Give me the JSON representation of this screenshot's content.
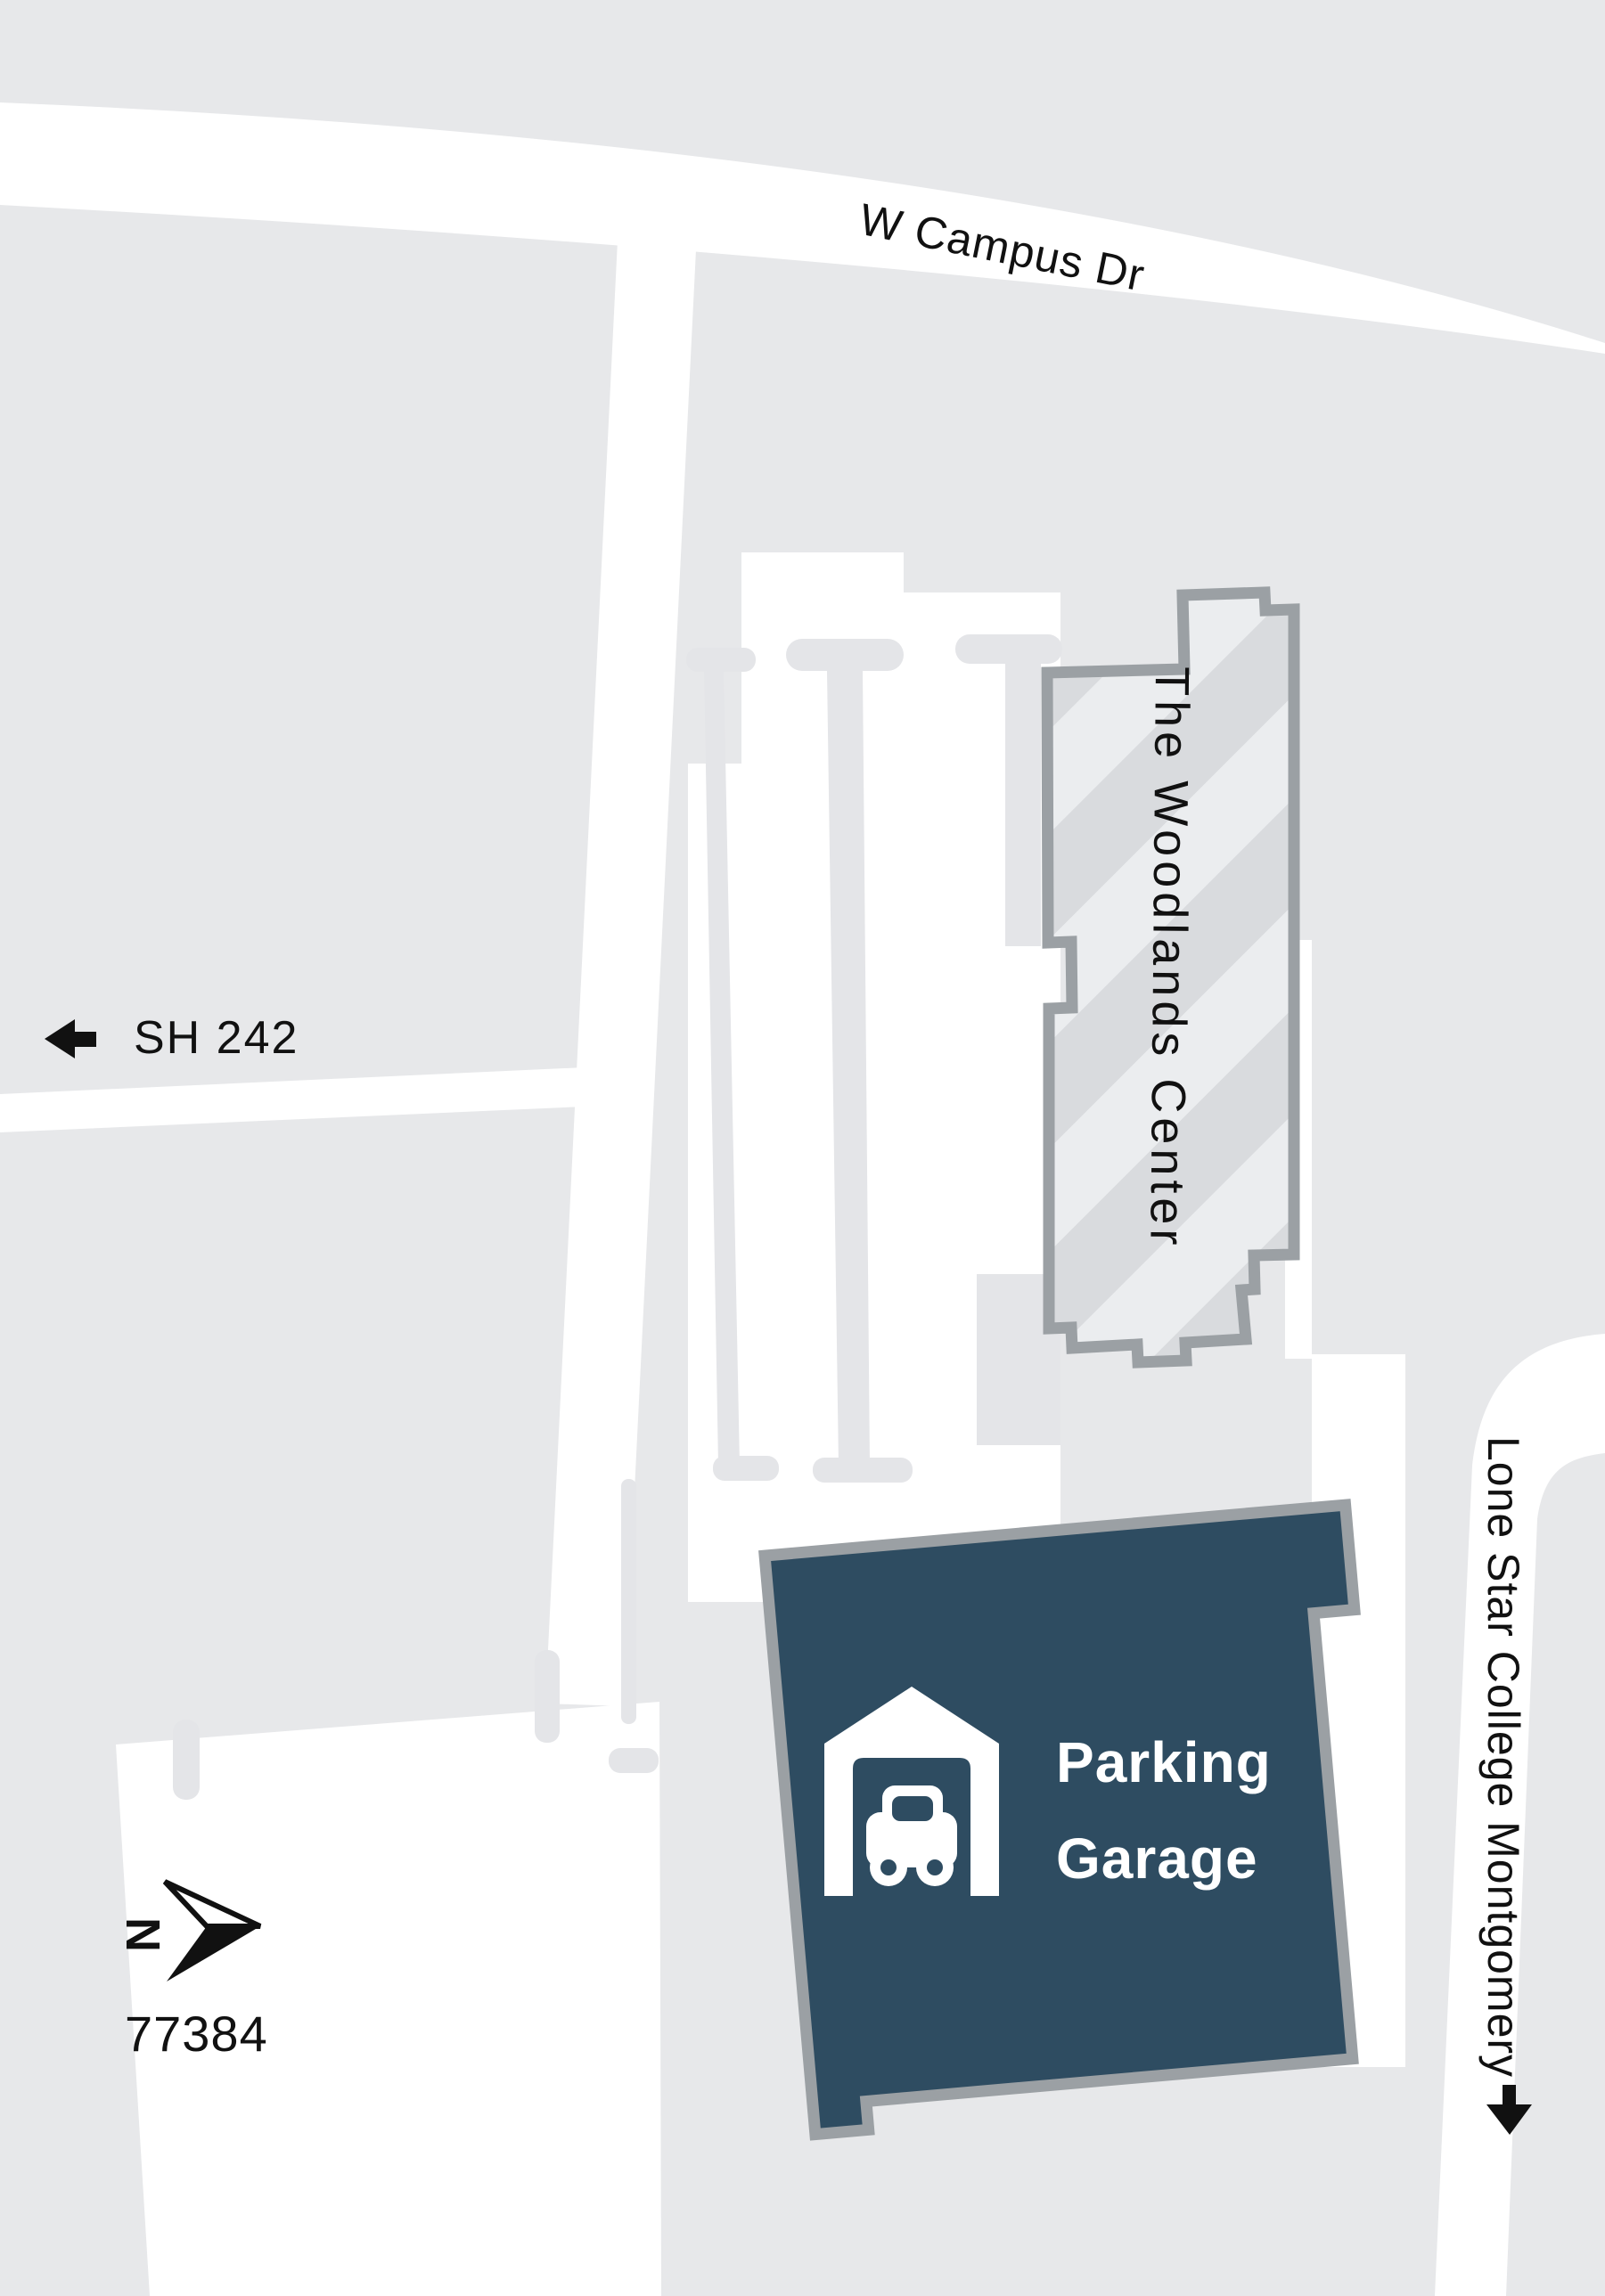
{
  "labels": {
    "road_top": "W Campus Dr",
    "highway": "SH 242",
    "road_right": "Lone Star College Montgomery",
    "building_center": "The Woodlands Center",
    "garage_line1": "Parking",
    "garage_line2": "Garage",
    "compass_north": "N",
    "zip_code": "77384"
  },
  "colors": {
    "background": "#e7e8ea",
    "road": "#ffffff",
    "building_fill": "#ebedef",
    "building_stripe": "#d9dbde",
    "building_outline": "#9ba0a4",
    "garage_fill": "#2e4c61",
    "garage_outline": "#9ba0a4",
    "label_text": "#111111",
    "garage_text": "#ffffff"
  },
  "icons": {
    "west_arrow": "left-arrow",
    "south_arrow": "down-arrow",
    "north_compass": "north-compass-arrow",
    "parking": "parking-garage-with-car"
  }
}
